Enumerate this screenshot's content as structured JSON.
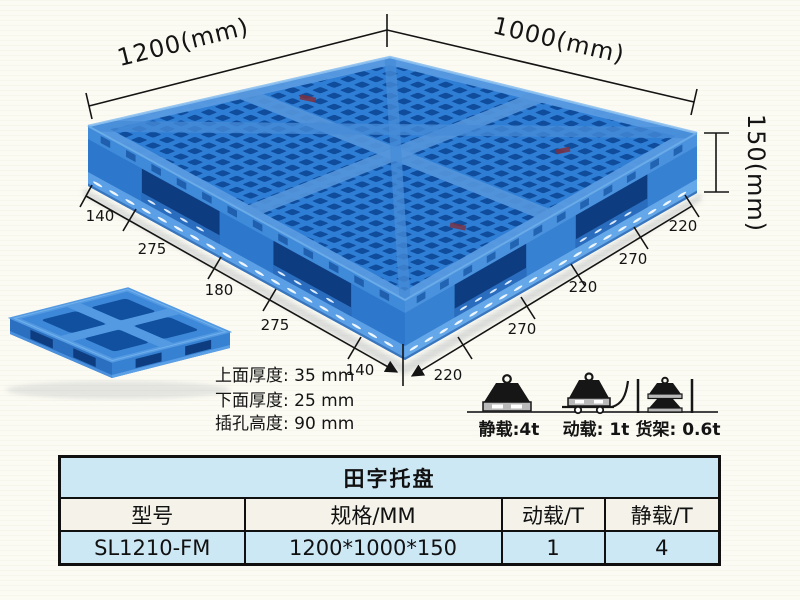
{
  "illustration": {
    "top_width_label": "1200(mm)",
    "top_depth_label": "1000(mm)",
    "height_label": "150(mm)",
    "bottom_left_segments": [
      "140",
      "275",
      "180",
      "275",
      "140"
    ],
    "bottom_right_segments": [
      "220",
      "270",
      "220",
      "270",
      "220"
    ],
    "notes": [
      "上面厚度: 35 mm",
      "下面厚度: 25 mm",
      "插孔高度: 90 mm"
    ],
    "loads": [
      {
        "icon": "static-load-weight-icon",
        "label": "静载:4t"
      },
      {
        "icon": "dynamic-load-trolley-icon",
        "label": "动载: 1t"
      },
      {
        "icon": "rack-load-icon",
        "label": "货架: 0.6t"
      }
    ],
    "colors": {
      "pallet_blue": "#2f7ed5",
      "pallet_dark_blue": "#0f4c9c",
      "pallet_light_blue": "#5ba0e6"
    }
  },
  "table": {
    "title": "田字托盘",
    "headers": [
      "型号",
      "规格/MM",
      "动载/T",
      "静载/T"
    ],
    "rows": [
      [
        "SL1210-FM",
        "1200*1000*150",
        "1",
        "4"
      ]
    ],
    "row_blue": "#cde8f5"
  }
}
